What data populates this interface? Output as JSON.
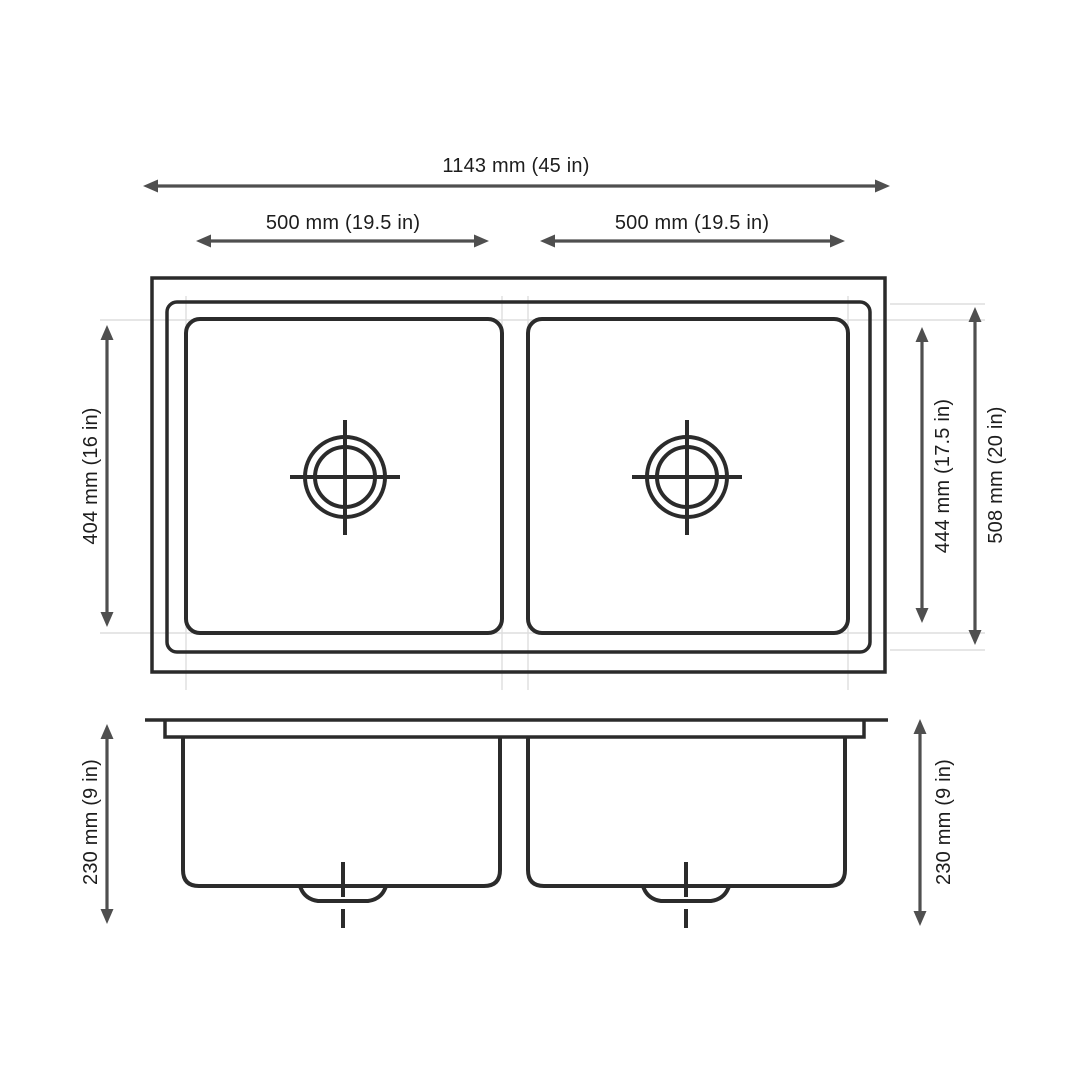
{
  "colors": {
    "background": "#ffffff",
    "drawing_line": "#2b2b2b",
    "dimension_line": "#4f4f4f",
    "label_text": "#1d1d1d",
    "extension_line": "#dedede"
  },
  "labels": {
    "overall_width": "1143 mm (45 in)",
    "left_bowl_width": "500 mm (19.5 in)",
    "right_bowl_width": "500 mm (19.5 in)",
    "bowl_front_to_back": "404 mm (16 in)",
    "inner_front_to_back": "444 mm (17.5 in)",
    "overall_front_to_back": "508 mm (20 in)",
    "left_bowl_depth": "230 mm (9 in)",
    "right_bowl_depth": "230 mm (9 in)"
  }
}
